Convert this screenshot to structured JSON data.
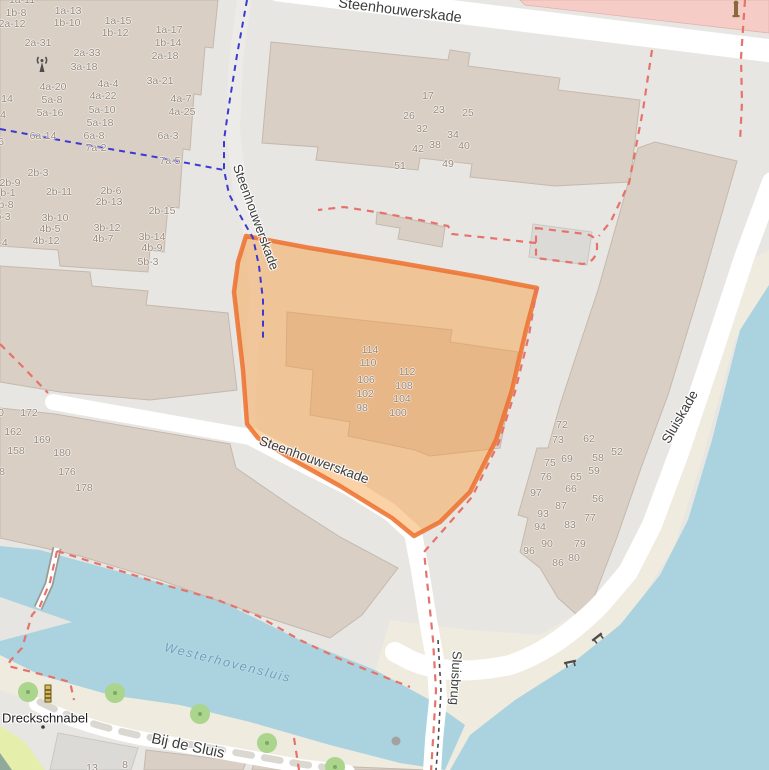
{
  "map": {
    "colors": {
      "background": "#e8e6e2",
      "water": "#aad3df",
      "quay": "#f0ebdf",
      "building": "#d9cfc5",
      "retail_area": "#f6ccc7",
      "grass": "#e6eeab",
      "selection_fill": "#f4a14a",
      "selection_border": "#ed7030",
      "boundary_red": "#e5736b",
      "boundary_blue": "#3b3ad0",
      "tree_green": "#abd48c"
    },
    "labels": [
      {
        "text": "Steenhouwerskade",
        "x": 400,
        "y": 11,
        "rot": 7,
        "type": "street",
        "size": 14.5
      },
      {
        "text": "Steenhouwerskade",
        "x": 256,
        "y": 217,
        "rot": 70,
        "type": "street",
        "size": 13
      },
      {
        "text": "Steenhouwerskade",
        "x": 314,
        "y": 460,
        "rot": 20,
        "type": "street",
        "size": 13.5
      },
      {
        "text": "Sluiskade",
        "x": 680,
        "y": 417,
        "rot": -60,
        "type": "street",
        "size": 13.5
      },
      {
        "text": "Sluisbrug",
        "x": 456,
        "y": 678,
        "rot": 93,
        "type": "street",
        "size": 13
      },
      {
        "text": "Bij de Sluis",
        "x": 188,
        "y": 746,
        "rot": 12,
        "type": "street",
        "size": 15
      },
      {
        "text": "Dreckschnabel",
        "x": 45,
        "y": 718,
        "rot": 0,
        "type": "place",
        "size": 13
      },
      {
        "text": "Westerhovensluis",
        "x": 228,
        "y": 663,
        "rot": 14,
        "type": "water-label",
        "size": 12.5
      }
    ],
    "housenumbers": [
      [
        22,
        0,
        "1a-11"
      ],
      [
        16,
        13,
        "1b-8"
      ],
      [
        68,
        11,
        "1a-13"
      ],
      [
        12,
        24,
        "2a-12"
      ],
      [
        67,
        23,
        "1b-10"
      ],
      [
        118,
        21,
        "1a-15"
      ],
      [
        115,
        33,
        "1b-12"
      ],
      [
        169,
        30,
        "1a-17"
      ],
      [
        168,
        43,
        "1b-14"
      ],
      [
        38,
        43,
        "2a-31"
      ],
      [
        87,
        53,
        "2a-33"
      ],
      [
        165,
        56,
        "2a-18"
      ],
      [
        84,
        67,
        "3a-18"
      ],
      [
        160,
        81,
        "3a-21"
      ],
      [
        53,
        87,
        "4a-20"
      ],
      [
        108,
        84,
        "4a-4"
      ],
      [
        103,
        96,
        "4a-22"
      ],
      [
        181,
        99,
        "4a-7"
      ],
      [
        52,
        100,
        "5a-8"
      ],
      [
        102,
        110,
        "5a-10"
      ],
      [
        182,
        112,
        "4a-25"
      ],
      [
        50,
        113,
        "5a-16"
      ],
      [
        100,
        123,
        "5a-18"
      ],
      [
        43,
        136,
        "6a-14"
      ],
      [
        94,
        136,
        "6a-8"
      ],
      [
        168,
        136,
        "6a-3"
      ],
      [
        96,
        148,
        "7a-2"
      ],
      [
        170,
        161,
        "7a-5"
      ],
      [
        7,
        99,
        "14"
      ],
      [
        3,
        115,
        "4"
      ],
      [
        1,
        142,
        "6"
      ],
      [
        38,
        173,
        "2b-3"
      ],
      [
        10,
        183,
        "2b-9"
      ],
      [
        59,
        192,
        "2b-11"
      ],
      [
        111,
        191,
        "2b-6"
      ],
      [
        109,
        202,
        "2b-13"
      ],
      [
        162,
        211,
        "2b-15"
      ],
      [
        55,
        218,
        "3b-10"
      ],
      [
        107,
        228,
        "3b-12"
      ],
      [
        50,
        229,
        "4b-5"
      ],
      [
        152,
        237,
        "3b-14"
      ],
      [
        46,
        241,
        "4b-12"
      ],
      [
        103,
        239,
        "4b-7"
      ],
      [
        152,
        248,
        "4b-9"
      ],
      [
        148,
        262,
        "5b-3"
      ],
      [
        8,
        193,
        "b-1"
      ],
      [
        6,
        205,
        "b-8"
      ],
      [
        3,
        217,
        "b-3"
      ],
      [
        3,
        243,
        "-4"
      ],
      [
        428,
        96,
        "17"
      ],
      [
        409,
        116,
        "26"
      ],
      [
        439,
        110,
        "23"
      ],
      [
        468,
        113,
        "25"
      ],
      [
        422,
        129,
        "32"
      ],
      [
        453,
        135,
        "34"
      ],
      [
        418,
        149,
        "42"
      ],
      [
        435,
        145,
        "38"
      ],
      [
        464,
        146,
        "40"
      ],
      [
        400,
        166,
        "51"
      ],
      [
        448,
        164,
        "49"
      ],
      [
        370,
        350,
        "114"
      ],
      [
        368,
        363,
        "110"
      ],
      [
        407,
        372,
        "112"
      ],
      [
        366,
        380,
        "106"
      ],
      [
        404,
        386,
        "108"
      ],
      [
        365,
        394,
        "102"
      ],
      [
        402,
        399,
        "104"
      ],
      [
        362,
        408,
        "98"
      ],
      [
        398,
        413,
        "100"
      ],
      [
        562,
        425,
        "72"
      ],
      [
        558,
        440,
        "73"
      ],
      [
        589,
        439,
        "62"
      ],
      [
        617,
        452,
        "52"
      ],
      [
        550,
        463,
        "75"
      ],
      [
        567,
        459,
        "69"
      ],
      [
        598,
        458,
        "58"
      ],
      [
        594,
        471,
        "59"
      ],
      [
        546,
        477,
        "76"
      ],
      [
        576,
        477,
        "65"
      ],
      [
        536,
        493,
        "97"
      ],
      [
        571,
        489,
        "66"
      ],
      [
        598,
        499,
        "56"
      ],
      [
        561,
        506,
        "87"
      ],
      [
        543,
        514,
        "93"
      ],
      [
        590,
        518,
        "77"
      ],
      [
        570,
        525,
        "83"
      ],
      [
        540,
        527,
        "94"
      ],
      [
        547,
        544,
        "90"
      ],
      [
        580,
        544,
        "79"
      ],
      [
        529,
        551,
        "96"
      ],
      [
        558,
        563,
        "86"
      ],
      [
        574,
        558,
        "80"
      ],
      [
        1,
        413,
        "0"
      ],
      [
        29,
        413,
        "172"
      ],
      [
        13,
        432,
        "162"
      ],
      [
        42,
        440,
        "169"
      ],
      [
        16,
        451,
        "158"
      ],
      [
        62,
        453,
        "180"
      ],
      [
        2,
        472,
        "8"
      ],
      [
        67,
        472,
        "176"
      ],
      [
        84,
        488,
        "178"
      ],
      [
        92,
        768,
        "13"
      ],
      [
        125,
        765,
        "8"
      ]
    ],
    "icons": [
      {
        "name": "antenna-mast-icon",
        "x": 42,
        "y": 64
      },
      {
        "name": "advertising-column-icon",
        "x": 736,
        "y": 9
      },
      {
        "name": "beacon-column-icon",
        "x": 48,
        "y": 694
      },
      {
        "name": "place-dot",
        "x": 43,
        "y": 727
      },
      {
        "name": "bench-icon",
        "x": 597,
        "y": 637
      },
      {
        "name": "bench-icon",
        "x": 570,
        "y": 662
      },
      {
        "name": "bollard-dot",
        "x": 396,
        "y": 741
      },
      {
        "name": "tree-icon",
        "x": 28,
        "y": 692
      },
      {
        "name": "tree-icon",
        "x": 115,
        "y": 693
      },
      {
        "name": "tree-icon",
        "x": 200,
        "y": 714
      },
      {
        "name": "tree-icon",
        "x": 267,
        "y": 743
      },
      {
        "name": "tree-icon",
        "x": 335,
        "y": 767
      }
    ]
  }
}
